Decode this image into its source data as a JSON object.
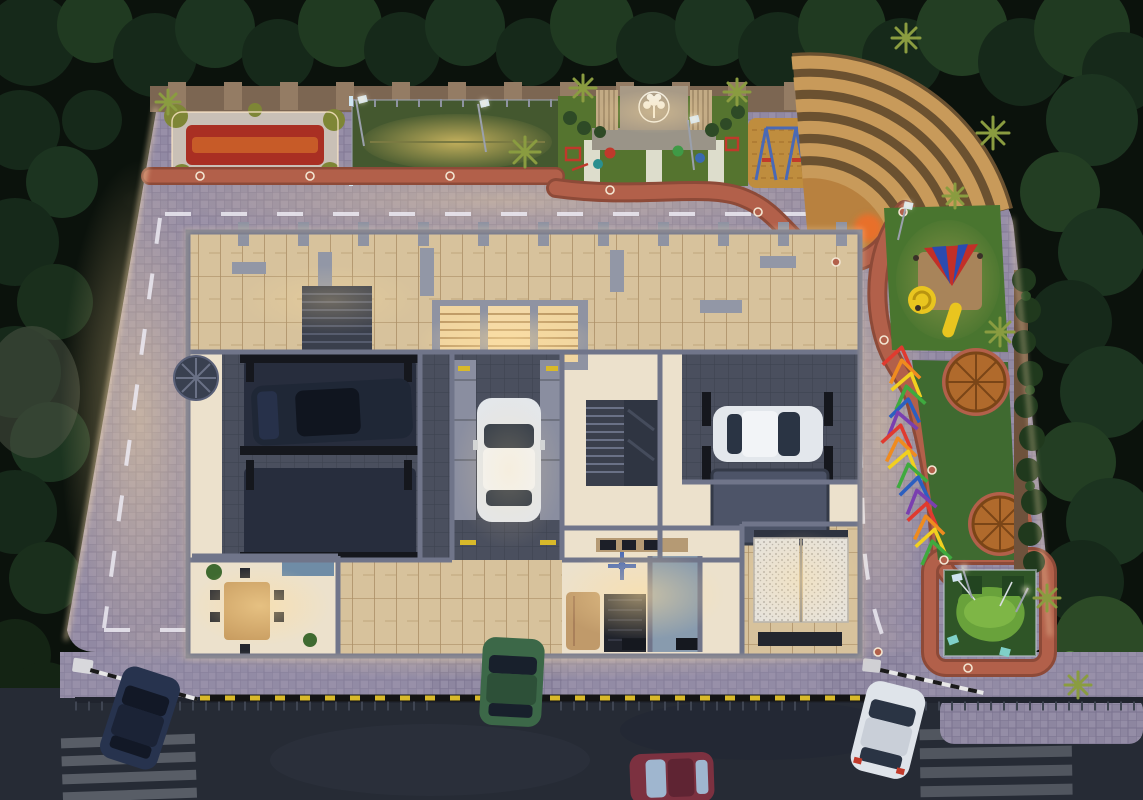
{
  "scene": {
    "title": "aerial-dusk-render-residential-podium-masterplan",
    "view": "top-down",
    "time_of_day": "dusk-night",
    "text_on_screen": ""
  },
  "palette": {
    "forest": "#0b120c",
    "treeMid": "#1c3120",
    "treeLight": "#2f4f2a",
    "palm": "#8a9c40",
    "asphalt": "#262b35",
    "crosswalk": "#ccd0d8",
    "paver": "#8d86a0",
    "paverLight": "#a29ab4",
    "ledWarm": "#ffdcae",
    "pathTerracotta": "#b2604a",
    "pathDark": "#8d4a38",
    "wallTan": "#7c6652",
    "pillarTan": "#947c64",
    "gravel": "#c9c0b6",
    "flowerRed": "#a92f23",
    "flowerOrange": "#c75b28",
    "shrubYellow": "#7e8636",
    "courtTurf": "#44582f",
    "courtLit": "#a9984f",
    "turf": "#49752f",
    "turfLit": "#6f9c43",
    "lawnDark": "#3f6a30",
    "stageLawn": "#55742f",
    "walkWhite": "#e9e6da",
    "stageDeck": "#9a9488",
    "slatPanel": "#c3ab85",
    "emblemWall": "#a89a86",
    "emblem": "#f3efe4",
    "sand": "#bf8d3e",
    "sandDark": "#a9762f",
    "amphiStep": "#c89a5a",
    "amphiGap": "#6b5130",
    "ballOrange": "#e8702a",
    "ballYellow": "#ecb32a",
    "ballPurple": "#8a5cb8",
    "swingBlue": "#4a69b5",
    "slideYellow": "#e9c51f",
    "canopyRed": "#c22f28",
    "canopyBlue": "#2b4bb0",
    "gazebo": "#b06a2c",
    "gazeboDark": "#7a4517",
    "hedge": "#20391d",
    "greenCourt": "#2f5527",
    "greenCourtLit": "#69a23b",
    "rainbow": [
      "#e03a2f",
      "#ef8b1f",
      "#f2d01f",
      "#3faa3f",
      "#2b5fc0",
      "#7a3fb0"
    ],
    "bldgWall": "#70758a",
    "bldgWallDark": "#4e5263",
    "floorCream": "#ece1cc",
    "wood": "#d7c29c",
    "woodLine": "#ab8f66",
    "tileDark": "#4a4f5e",
    "palletNavy": "#272d3d",
    "palletGray": "#4d5468",
    "canopyBlack": "#15171d",
    "stairDark": "#3a3f4c",
    "sofaTan": "#c09a6a",
    "tableWood": "#c79b5f",
    "rugBlack": "#20232c",
    "bathBlue": "#7d94ab",
    "duvet": "#e7e3db",
    "hazardYellow": "#d8b92a"
  },
  "vehicles": [
    {
      "name": "suv-dark-blue-road",
      "color": "#27334e",
      "location": "bottom-left entry"
    },
    {
      "name": "sedan-green-road",
      "color": "#3c6848",
      "location": "entry gate"
    },
    {
      "name": "sedan-maroon-road",
      "color": "#7c3140",
      "location": "bottom road"
    },
    {
      "name": "hatchback-white-road",
      "color": "#dfe4ea",
      "location": "exit gate"
    },
    {
      "name": "parked-car-white-center",
      "color": "#e3e7ec",
      "location": "central stack-parking bay"
    },
    {
      "name": "parked-car-white-right",
      "color": "#e3e7ec",
      "location": "right parking wing"
    },
    {
      "name": "parked-car-dark-left",
      "color": "#1f2736",
      "location": "left parking wing"
    }
  ],
  "amenities": [
    {
      "name": "flower-garden",
      "label": "flower garden bed"
    },
    {
      "name": "practice-court",
      "label": "fenced net-cricket practice court"
    },
    {
      "name": "stage-lawn",
      "label": "event lawn with stage and tree-of-life feature wall"
    },
    {
      "name": "swing-pit",
      "label": "sand pit with swings"
    },
    {
      "name": "amphitheatre",
      "label": "curved seating amphitheatre with glowing poufs"
    },
    {
      "name": "kids-playground",
      "label": "children's play area with slides and canopy"
    },
    {
      "name": "rattan-gazebos",
      "label": "two circular rattan gazebos"
    },
    {
      "name": "rainbow-pergola",
      "label": "rainbow arch walkway"
    },
    {
      "name": "putting-green",
      "label": "fenced putting green / lawn court"
    }
  ],
  "building": {
    "wings": [
      "left-parking-wing",
      "central-car-bay",
      "right-parking-wing"
    ],
    "rooms": [
      "office-dining-room",
      "living-room",
      "kitchen",
      "bathroom",
      "bedroom-twin-beds"
    ],
    "features": [
      "wood-deck-terrace",
      "lit-shutter-niches",
      "staircase",
      "spiral-staircase",
      "stack-parking-pallets"
    ]
  },
  "site": {
    "roads": [
      "internal-driveway-loop-dashed",
      "public-road"
    ],
    "gates": [
      "entry-gate-with-boom-barrier",
      "exit-gate-with-boom-barrier"
    ],
    "lighting": [
      "led-strip-podium-edges",
      "path-bollard-rings",
      "pole-lights"
    ],
    "crosswalks": 2
  }
}
